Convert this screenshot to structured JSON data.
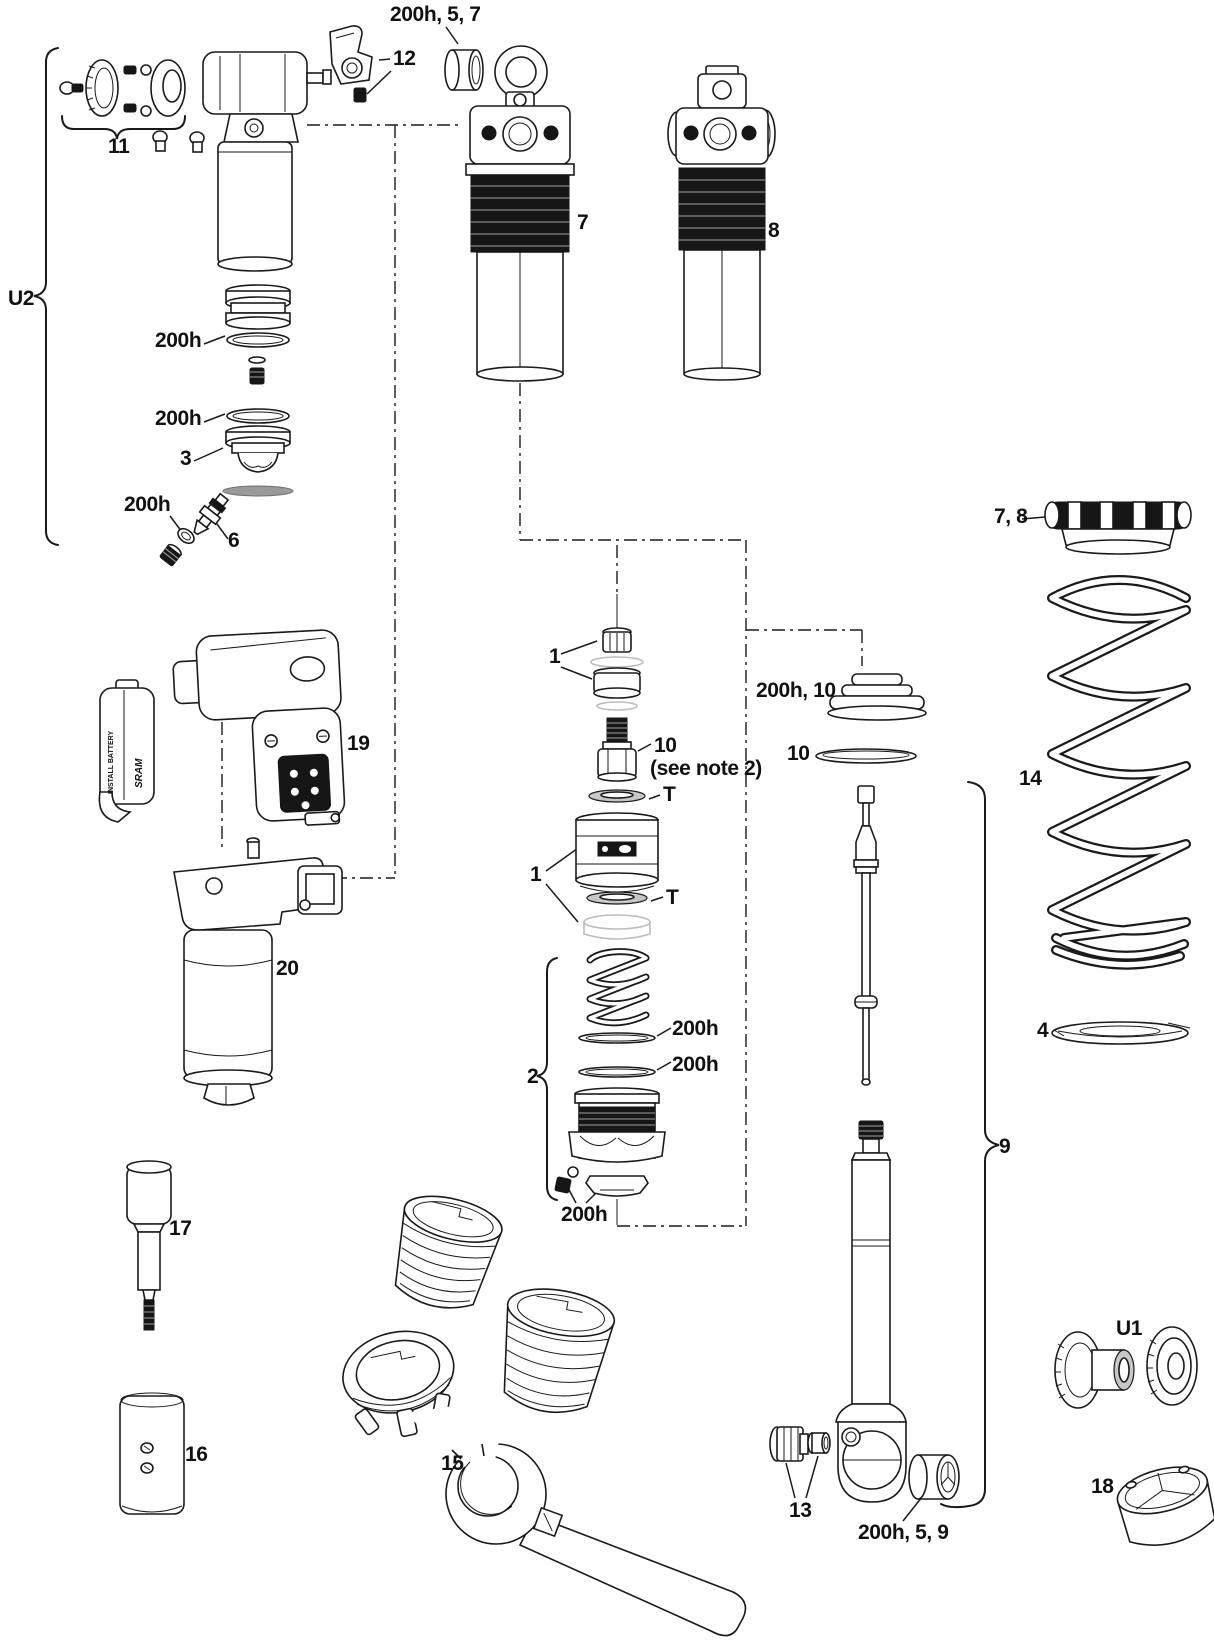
{
  "diagram": {
    "kind": "rear-shock-exploded-parts-diagram",
    "background": "#ffffff"
  },
  "colors": {
    "line": "#1a1a1a",
    "dark_fill": "#161616",
    "seal_gray": "#c6c6c6",
    "plate_gray": "#9a9a9a",
    "ghost": "#bdbdbd"
  },
  "battery_blocker": {
    "warning_text": "INSTALL BATTERY",
    "brand_text": "SRAM"
  },
  "labels": [
    {
      "id": "callout-200h-5-7",
      "text": "200h, 5, 7"
    },
    {
      "id": "callout-12",
      "text": "12"
    },
    {
      "id": "callout-11",
      "text": "11"
    },
    {
      "id": "callout-u2",
      "text": "U2"
    },
    {
      "id": "callout-200h-a",
      "text": "200h"
    },
    {
      "id": "callout-200h-b",
      "text": "200h"
    },
    {
      "id": "callout-3",
      "text": "3"
    },
    {
      "id": "callout-200h-c",
      "text": "200h"
    },
    {
      "id": "callout-6",
      "text": "6"
    },
    {
      "id": "callout-7",
      "text": "7"
    },
    {
      "id": "callout-8",
      "text": "8"
    },
    {
      "id": "callout-1-upper",
      "text": "1"
    },
    {
      "id": "callout-10-upper",
      "text": "10"
    },
    {
      "id": "callout-see-note-2",
      "text": "(see note 2)"
    },
    {
      "id": "callout-t-upper",
      "text": "T"
    },
    {
      "id": "callout-1-lower",
      "text": "1"
    },
    {
      "id": "callout-t-lower",
      "text": "T"
    },
    {
      "id": "callout-200h-10",
      "text": "200h, 10"
    },
    {
      "id": "callout-10-lower",
      "text": "10"
    },
    {
      "id": "callout-2",
      "text": "2"
    },
    {
      "id": "callout-200h-d",
      "text": "200h"
    },
    {
      "id": "callout-200h-e",
      "text": "200h"
    },
    {
      "id": "callout-200h-f",
      "text": "200h"
    },
    {
      "id": "callout-19",
      "text": "19"
    },
    {
      "id": "callout-20",
      "text": "20"
    },
    {
      "id": "callout-17",
      "text": "17"
    },
    {
      "id": "callout-16",
      "text": "16"
    },
    {
      "id": "callout-15",
      "text": "15"
    },
    {
      "id": "callout-13",
      "text": "13"
    },
    {
      "id": "callout-200h-5-9",
      "text": "200h, 5, 9"
    },
    {
      "id": "callout-9",
      "text": "9"
    },
    {
      "id": "callout-7-8",
      "text": "7, 8"
    },
    {
      "id": "callout-14",
      "text": "14"
    },
    {
      "id": "callout-4",
      "text": "4"
    },
    {
      "id": "callout-u1",
      "text": "U1"
    },
    {
      "id": "callout-18",
      "text": "18"
    }
  ]
}
